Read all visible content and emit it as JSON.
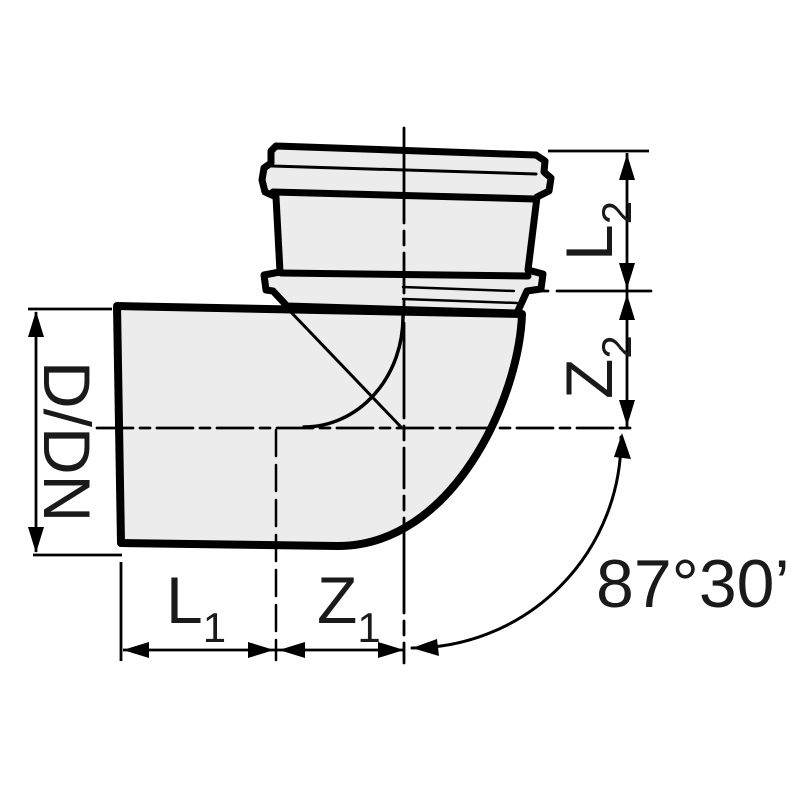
{
  "page": {
    "background": "#ffffff"
  },
  "drawing": {
    "kind": "pipe-bend-dimensional-drawing",
    "colors": {
      "line": "#000000",
      "body_fill": "#ececec"
    },
    "labels": {
      "diameter": "D/DN",
      "l1": {
        "main": "L",
        "sub": "1"
      },
      "z1": {
        "main": "Z",
        "sub": "1"
      },
      "l2": {
        "main": "L",
        "sub": "2"
      },
      "z2": {
        "main": "Z",
        "sub": "2"
      },
      "angle": "87°30’"
    }
  }
}
